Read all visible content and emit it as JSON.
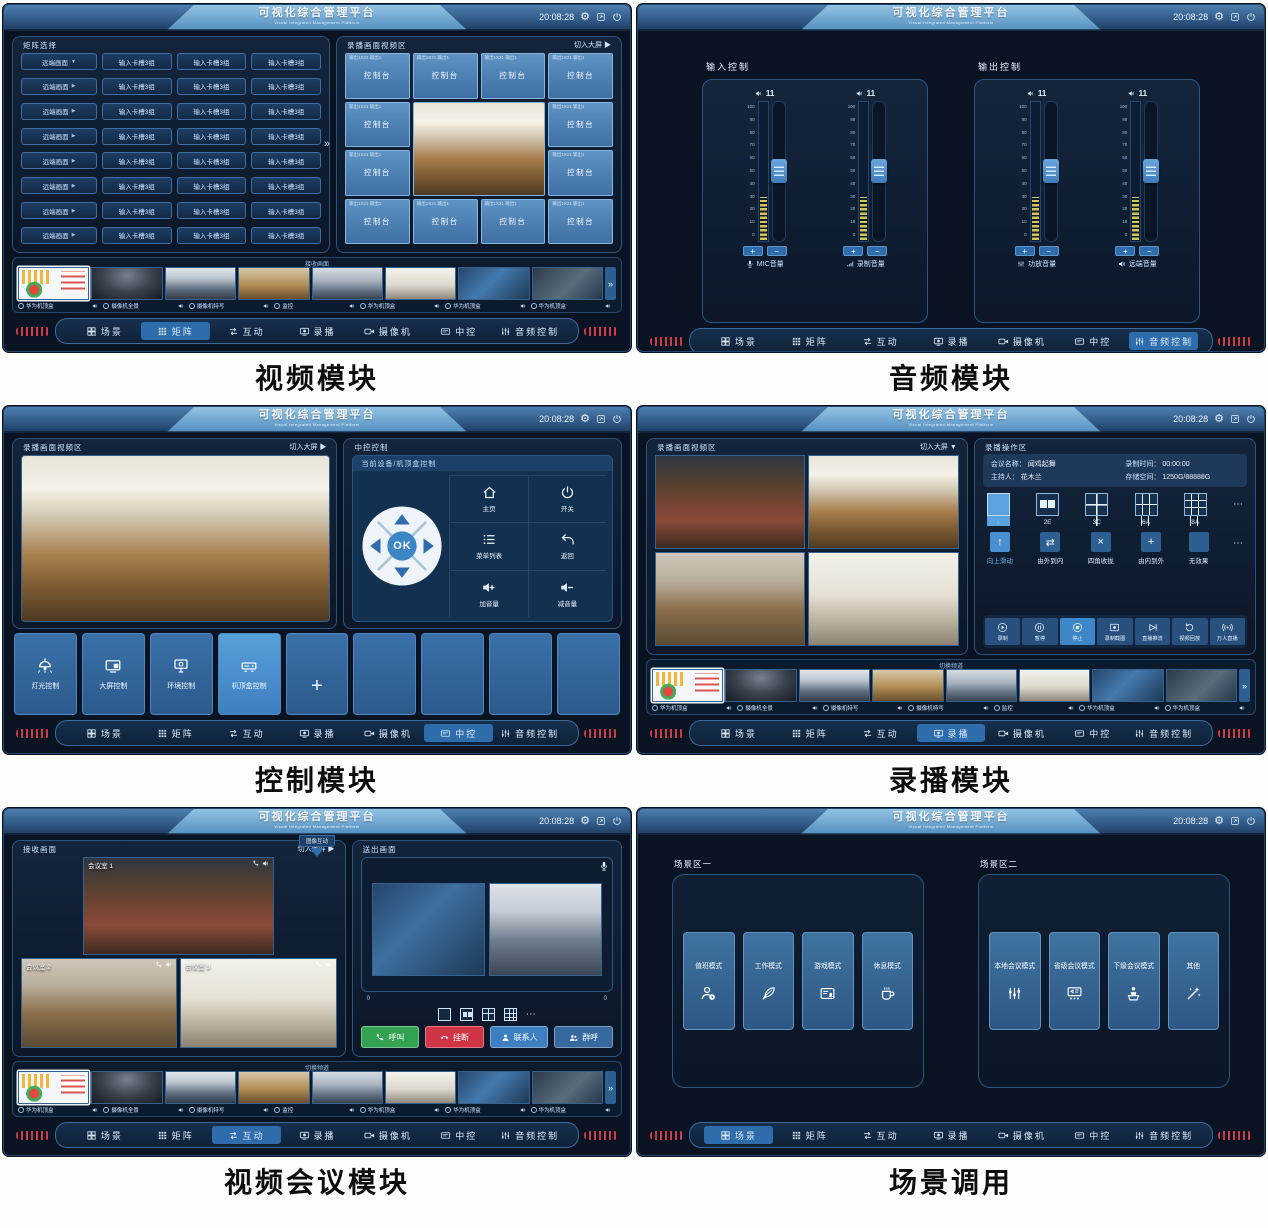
{
  "header": {
    "title": "可视化综合管理平台",
    "subtitle": "Visual Integrated Management Platform",
    "time": "20:08:28",
    "gear": "⚙"
  },
  "nav": {
    "items": [
      {
        "label": "场景",
        "icon": "#i-scenes"
      },
      {
        "label": "矩阵",
        "icon": "#i-matrix"
      },
      {
        "label": "互动",
        "icon": "#i-interact"
      },
      {
        "label": "录播",
        "icon": "#i-record"
      },
      {
        "label": "摄像机",
        "icon": "#i-camera"
      },
      {
        "label": "中控",
        "icon": "#i-central"
      },
      {
        "label": "音频控制",
        "icon": "#i-audio"
      }
    ]
  },
  "panels": {
    "video": {
      "caption": "视频模块",
      "active_nav": 1,
      "matrix": {
        "title": "矩阵选择",
        "expand": "»",
        "rows": [
          {
            "c1": "远端画面",
            "caret": "▼",
            "c2": "输入卡槽3组",
            "c3": "输入卡槽3组",
            "c4": "输入卡槽3组"
          },
          {
            "c1": "远端画面",
            "caret": "▶",
            "c2": "输入卡槽3组",
            "c3": "输入卡槽3组",
            "c4": "输入卡槽3组"
          },
          {
            "c1": "远端画面",
            "caret": "▶",
            "c2": "输入卡槽3组",
            "c3": "输入卡槽3组",
            "c4": "输入卡槽3组"
          },
          {
            "c1": "远端画面",
            "caret": "▶",
            "c2": "输入卡槽3组",
            "c3": "输入卡槽3组",
            "c4": "输入卡槽3组"
          },
          {
            "c1": "远端画面",
            "caret": "▶",
            "c2": "输入卡槽3组",
            "c3": "输入卡槽3组",
            "c4": "输入卡槽3组"
          },
          {
            "c1": "远端画面",
            "caret": "▶",
            "c2": "输入卡槽3组",
            "c3": "输入卡槽3组",
            "c4": "输入卡槽3组"
          },
          {
            "c1": "远端画面",
            "caret": "▶",
            "c2": "输入卡槽3组",
            "c3": "输入卡槽3组",
            "c4": "输入卡槽3组"
          },
          {
            "c1": "远端画面",
            "caret": "▶",
            "c2": "输入卡槽3组",
            "c3": "输入卡槽3组",
            "c4": "输入卡槽3组"
          }
        ]
      },
      "video_area": {
        "title": "录播画面视频区",
        "switch": "切入大屏 ▶",
        "tiles": [
          {
            "sub": "输出1X21 输出1",
            "label": "控制台"
          },
          {
            "sub": "输出1X21 输出1",
            "label": "控制台"
          },
          {
            "sub": "输出1X21 输出1",
            "label": "控制台"
          },
          {
            "sub": "输出1X21 输出1",
            "label": "控制台"
          },
          {
            "sub": "输出1X21 输出1",
            "label": "控制台"
          },
          {
            "sub": "输出1X21 输出1",
            "label": "控制台"
          },
          {
            "sub": "输出1X21 输出1",
            "label": "控制台"
          },
          {
            "sub": "输出1X21 输出1",
            "label": "控制台"
          },
          {
            "sub": "输出1X21 输出1",
            "label": "控制台"
          },
          {
            "sub": "输出1X21 输出1",
            "label": "控制台"
          },
          {
            "sub": "输出1X21 输出1",
            "label": "控制台"
          },
          {
            "sub": "输出1X21 输出1",
            "label": "控制台"
          }
        ]
      },
      "strip": {
        "title": "接收画面",
        "chevron": "»",
        "thumbs": [
          {
            "kind": "t-chart sel"
          },
          {
            "kind": "t-dome"
          },
          {
            "kind": "t-people"
          },
          {
            "kind": "t-counter"
          },
          {
            "kind": "t-people2"
          },
          {
            "kind": "t-hall"
          },
          {
            "kind": "t-screens"
          },
          {
            "kind": "t-laptop"
          }
        ],
        "captions": [
          "华为机顶盒",
          "摄像机全景",
          "摄像机特写",
          "监控",
          "华为机顶盒",
          "华为机顶盒",
          "华为机顶盒"
        ]
      }
    },
    "audio": {
      "caption": "音频模块",
      "active_nav": 6,
      "plus": "+",
      "minus": "−",
      "input": {
        "title": "输入控制",
        "sliders": [
          {
            "value": "11",
            "ticks": "100\n90\n80\n70\n60\n50\n40\n30\n20\n10\n0",
            "label": "MIC音量",
            "icon": "#i-mic"
          },
          {
            "value": "11",
            "ticks": "100\n90\n80\n70\n60\n50\n40\n30\n20\n10\n0",
            "label": "录制音量",
            "icon": "#i-signal"
          }
        ]
      },
      "output": {
        "title": "输出控制",
        "sliders": [
          {
            "value": "11",
            "ticks": "100\n90\n80\n70\n60\n50\n40\n30\n20\n10\n0",
            "label": "功放音量",
            "icon": "#i-mixer"
          },
          {
            "value": "11",
            "ticks": "100\n90\n80\n70\n60\n50\n40\n30\n20\n10\n0",
            "label": "远端音量",
            "icon": "#i-speaker"
          }
        ]
      }
    },
    "control": {
      "caption": "控制模块",
      "active_nav": 5,
      "video_area": {
        "title": "录播画面视频区",
        "switch": "切入大屏 ▶"
      },
      "center": {
        "title": "中控控制",
        "subtitle": "当前设备/机顶盒控制",
        "ok": "OK",
        "buttons": [
          {
            "label": "主页",
            "icon": "#i-home"
          },
          {
            "label": "开关",
            "icon": "#i-power"
          },
          {
            "label": "菜单列表",
            "icon": "#i-list"
          },
          {
            "label": "返回",
            "icon": "#i-back"
          },
          {
            "label": "加音量",
            "icon": "#i-volup"
          },
          {
            "label": "减音量",
            "icon": "#i-voldown"
          }
        ]
      },
      "tiles": [
        {
          "label": "灯光控制",
          "icon": "#i-lamp"
        },
        {
          "label": "大屏控制",
          "icon": "#i-bigscreen"
        },
        {
          "label": "环境控制",
          "icon": "#i-env"
        },
        {
          "label": "机顶盒控制",
          "icon": "#i-settop",
          "active": true
        },
        {
          "label": "+",
          "kind": "plus"
        },
        {
          "kind": "empty"
        },
        {
          "kind": "empty"
        },
        {
          "kind": "empty"
        },
        {
          "kind": "empty"
        }
      ]
    },
    "record": {
      "caption": "录播模块",
      "active_nav": 3,
      "video_area": {
        "title": "录播画面视频区",
        "switch": "切入大屏 ▼"
      },
      "ops": {
        "title": "录播操作区",
        "info": {
          "name_k": "会议名称：",
          "name_v": "闻鸡起舞",
          "time_k": "录制时间：",
          "time_v": "00:00:00",
          "host_k": "主持人：",
          "host_v": "花木兰",
          "storage_k": "存储空间：",
          "storage_v": "1250G/88888G"
        },
        "layouts_more": "⋯",
        "layouts": [
          {
            "label": "1",
            "kind": "g1",
            "active": true
          },
          {
            "label": "2E",
            "kind": "g2"
          },
          {
            "label": "3C",
            "kind": "g4"
          },
          {
            "label": "6A",
            "kind": "g6"
          },
          {
            "label": "8A",
            "kind": "g8"
          }
        ],
        "transitions_more": "⋯",
        "transitions": [
          {
            "label": "向上滑动",
            "glyph": "↑",
            "active": true
          },
          {
            "label": "由外到内",
            "glyph": "⇄"
          },
          {
            "label": "四角收拢",
            "glyph": "×"
          },
          {
            "label": "由内到外",
            "glyph": "+"
          },
          {
            "label": "无效果",
            "glyph": ""
          }
        ],
        "playback": [
          {
            "label": "录制",
            "icon": "#i-play"
          },
          {
            "label": "暂停",
            "icon": "#i-pause"
          },
          {
            "label": "停止",
            "icon": "#i-stop",
            "active": true
          },
          {
            "label": "录制截图",
            "icon": "#i-recdot"
          },
          {
            "label": "直播推流",
            "icon": "#i-stream"
          },
          {
            "label": "视频回放",
            "icon": "#i-replay"
          },
          {
            "label": "万人直播",
            "icon": "#i-live"
          }
        ]
      },
      "strip": {
        "title": "切换频道",
        "chevron": "»",
        "thumbs": [
          {
            "kind": "t-chart sel"
          },
          {
            "kind": "t-dome"
          },
          {
            "kind": "t-people"
          },
          {
            "kind": "t-counter"
          },
          {
            "kind": "t-people2"
          },
          {
            "kind": "t-hall"
          },
          {
            "kind": "t-screens"
          },
          {
            "kind": "t-laptop"
          }
        ],
        "captions": [
          "华为机顶盒",
          "摄像机全景",
          "摄像机特写",
          "摄像机特写",
          "监控",
          "华为机顶盒",
          "华为机顶盒"
        ]
      }
    },
    "interact": {
      "caption": "视频会议模块",
      "active_nav": 2,
      "tab": "图像互动",
      "receive": {
        "title": "接收画面",
        "switch": "切入大屏 ▶",
        "rooms": {
          "r1": "会议室 1",
          "r2": "会议室 2",
          "r3": "会议室 3"
        }
      },
      "send": {
        "title": "送出画面",
        "zero_left": "0",
        "zero_right": "0",
        "more": "⋯",
        "buttons": [
          {
            "label": "呼叫",
            "kind": "green",
            "icon": "#i-phone"
          },
          {
            "label": "挂断",
            "kind": "red",
            "icon": "#i-phone-down"
          },
          {
            "label": "联系人",
            "kind": "blue",
            "icon": "#i-person"
          },
          {
            "label": "群呼",
            "kind": "blue2",
            "icon": "#i-people"
          }
        ]
      },
      "strip": {
        "title": "切换频道",
        "chevron": "»",
        "thumbs": [
          {
            "kind": "t-chart sel"
          },
          {
            "kind": "t-dome"
          },
          {
            "kind": "t-people"
          },
          {
            "kind": "t-counter"
          },
          {
            "kind": "t-people2"
          },
          {
            "kind": "t-hall"
          },
          {
            "kind": "t-screens"
          },
          {
            "kind": "t-laptop"
          }
        ],
        "captions": [
          "华为机顶盒",
          "摄像机全景",
          "摄像机特写",
          "监控",
          "华为机顶盒",
          "华为机顶盒",
          "华为机顶盒"
        ]
      }
    },
    "scene": {
      "caption": "场景调用",
      "active_nav": 0,
      "groups": [
        {
          "title": "场景区一",
          "cards": [
            {
              "label": "值班模式",
              "icon": "#i-duty"
            },
            {
              "label": "工作模式",
              "icon": "#i-feather"
            },
            {
              "label": "游戏模式",
              "icon": "#i-cardg"
            },
            {
              "label": "休息模式",
              "icon": "#i-coffee"
            }
          ]
        },
        {
          "title": "场景区二",
          "cards": [
            {
              "label": "本地会议模式",
              "icon": "#i-mixer"
            },
            {
              "label": "省级会议模式",
              "icon": "#i-meeting"
            },
            {
              "label": "下级会议模式",
              "icon": "#i-podium"
            },
            {
              "label": "其他",
              "icon": "#i-wand"
            }
          ]
        }
      ]
    }
  }
}
